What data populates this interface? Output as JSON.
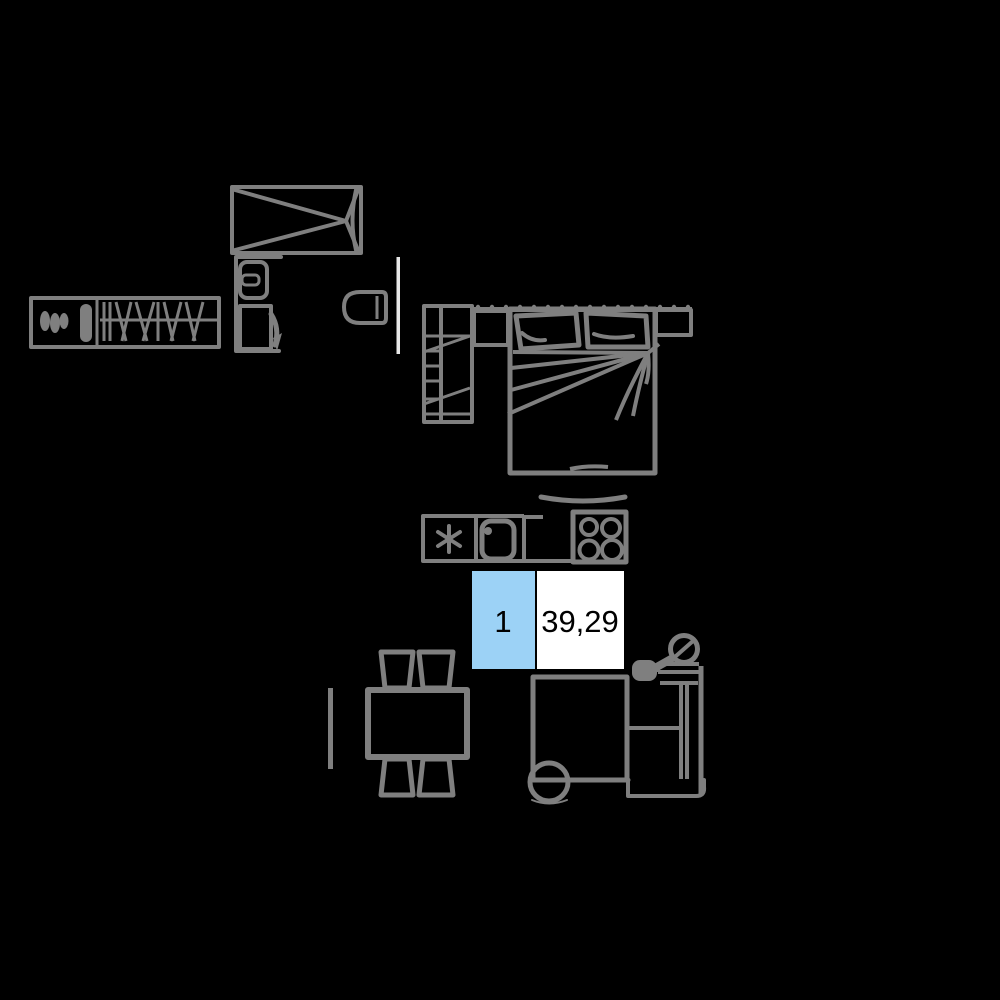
{
  "canvas": {
    "width": 1000,
    "height": 1000,
    "background": "#000000"
  },
  "colors": {
    "furniture_stroke": "#7F7F7F",
    "wall_segment": "#E8E8E8",
    "unit_number_fill": "#9CD2F6",
    "unit_area_fill": "#FFFFFF",
    "label_border": "#000000",
    "label_text": "#000000"
  },
  "unit_label": {
    "number": "1",
    "area": "39,29"
  },
  "furniture": {
    "items": [
      "mirrored wardrobe",
      "washer cabinet with door swing",
      "hanger wardrobe with clothes",
      "toilet",
      "wall segment",
      "ladder shelf",
      "window cornice",
      "double bed with pillows and blanket",
      "nightstand left",
      "nightstand right",
      "kitchen hood",
      "fridge",
      "kitchen sink",
      "stove with four burners",
      "kitchen counter",
      "radiator",
      "dining table",
      "four chairs",
      "sofa with footrest",
      "floor lamp",
      "side table",
      "round ottoman"
    ]
  }
}
